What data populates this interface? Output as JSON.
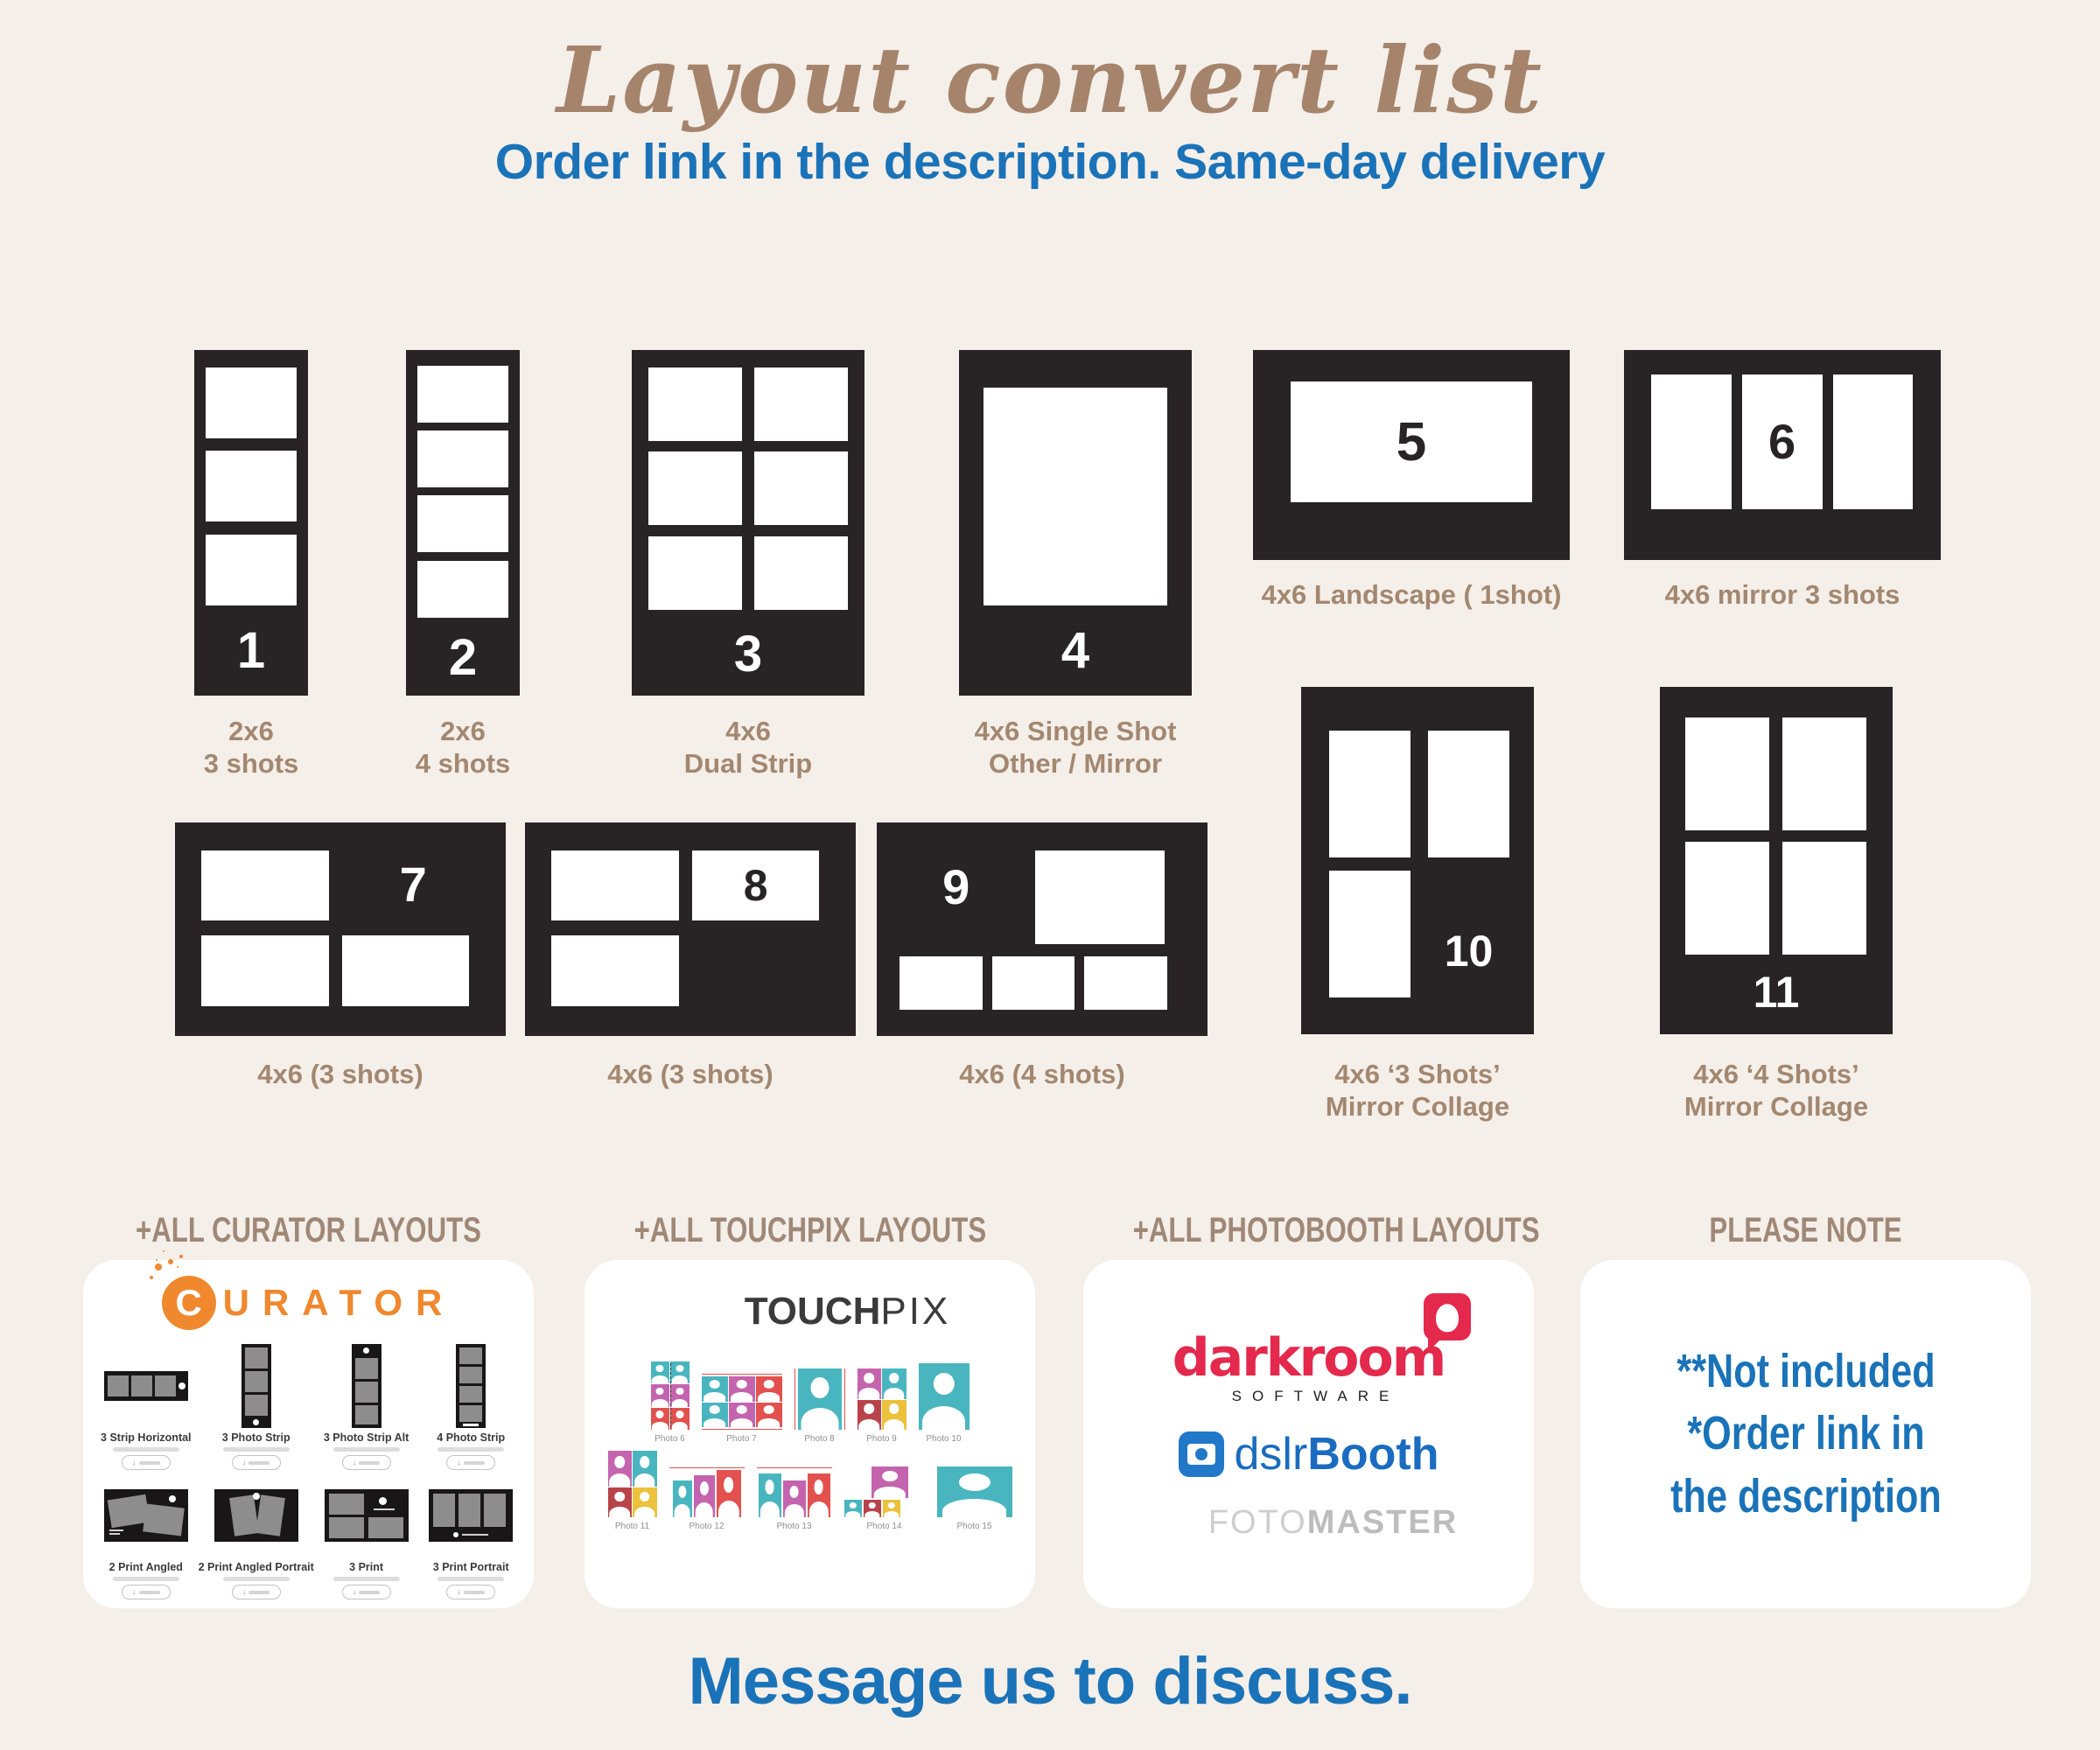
{
  "title": "Layout convert list",
  "subtitle": "Order link in the description. Same-day delivery",
  "footer": "Message us to discuss.",
  "colors": {
    "background": "#f5efea",
    "card_black": "#282324",
    "title_brown": "#a5846b",
    "label_brown": "#a3876f",
    "blue": "#1a73b8",
    "curator_orange": "#f0882e",
    "darkroom_red": "#e4294d",
    "dslrbooth_blue": "#1a6cc0",
    "touchpix_teal": "#49b6bf",
    "touchpix_magenta": "#c564ae",
    "touchpix_red": "#e2514e",
    "touchpix_yellow": "#ecc23d"
  },
  "layouts": [
    {
      "number": "1",
      "label1": "2x6",
      "label2": "3 shots"
    },
    {
      "number": "2",
      "label1": "2x6",
      "label2": "4 shots"
    },
    {
      "number": "3",
      "label1": "4x6",
      "label2": "Dual Strip"
    },
    {
      "number": "4",
      "label1": "4x6 Single Shot",
      "label2": "Other / Mirror"
    },
    {
      "number": "5",
      "label1": "4x6 Landscape ( 1shot)"
    },
    {
      "number": "6",
      "label1": "4x6 mirror 3 shots"
    },
    {
      "number": "7",
      "label1": "4x6 (3 shots)"
    },
    {
      "number": "8",
      "label1": "4x6 (3 shots)"
    },
    {
      "number": "9",
      "label1": "4x6 (4 shots)"
    },
    {
      "number": "10",
      "label1": "4x6 ‘3 Shots’",
      "label2": "Mirror Collage"
    },
    {
      "number": "11",
      "label1": "4x6 ‘4 Shots’",
      "label2": "Mirror Collage"
    }
  ],
  "curator": {
    "header": "+ALL CURATOR LAYOUTS",
    "logo_c": "C",
    "logo_rest": "URATOR",
    "tiles": [
      "3 Strip Horizontal",
      "3 Photo Strip",
      "3 Photo Strip Alt",
      "4 Photo Strip",
      "2 Print Angled",
      "2 Print Angled Portrait",
      "3 Print",
      "3 Print Portrait"
    ]
  },
  "touchpix": {
    "header": "+ALL TOUCHPIX LAYOUTS",
    "logo_bold": "TOUCH",
    "logo_light": "PIX",
    "captions": [
      "Photo 6",
      "Photo 7",
      "Photo 8",
      "Photo 9",
      "Photo 10",
      "Photo 11",
      "Photo 12",
      "Photo 13",
      "Photo 14",
      "Photo 15"
    ]
  },
  "photobooth": {
    "header": "+ALL PHOTOBOOTH LAYOUTS",
    "darkroom": "darkroom",
    "darkroom_sub": "SOFTWARE",
    "dslr_light": "dslr",
    "dslr_bold": "Booth",
    "foto_light": "FOTO",
    "foto_bold": "MASTER"
  },
  "note": {
    "header": "PLEASE NOTE",
    "line1": "**Not included",
    "line2": "*Order link in the description"
  }
}
